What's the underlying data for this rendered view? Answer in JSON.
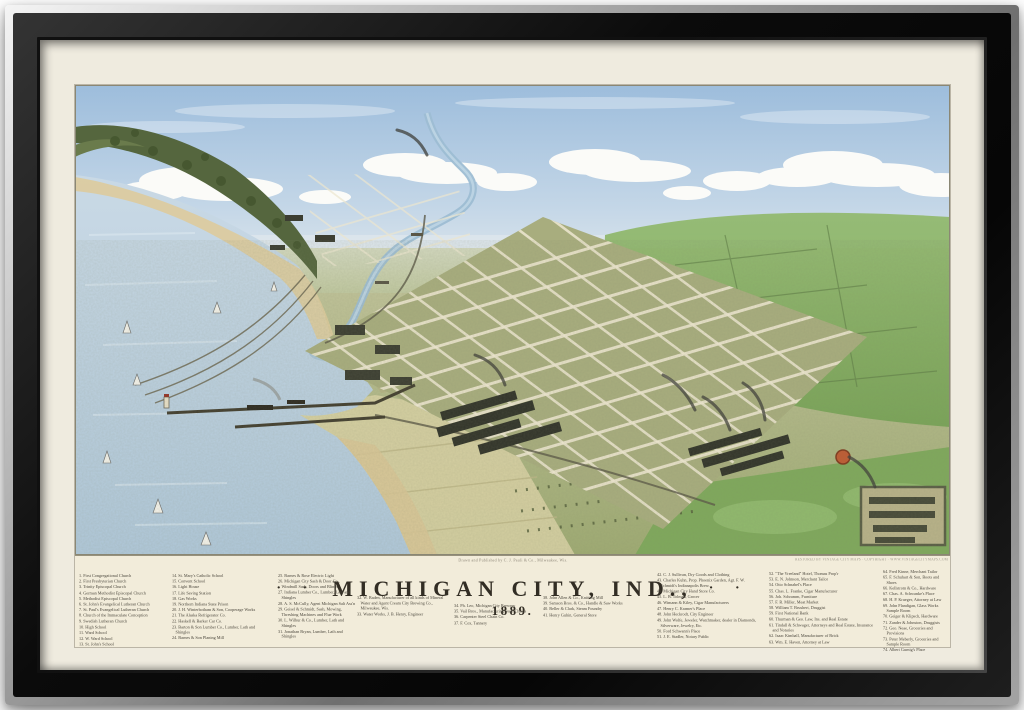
{
  "artwork": {
    "title": "MICHIGAN CITY, IND.,",
    "year": "1889.",
    "title_dots_left": "·  ·",
    "title_dots_right": "·  ·",
    "publisher_line": "Drawn and Published by C. J. Pauli & Co., Milwaukee, Wis.",
    "restored_line": "RESTORED BY VINTAGE CITY MAPS · COPYRIGHT · WWW.VINTAGECITYMAPS.COM"
  },
  "colors": {
    "frame_black": "#0b0b0b",
    "frame_silver": "#c2c2c2",
    "mat_cream": "#efebdf",
    "paper_cream": "#f2ecda",
    "sky_blue": "#a6c4e0",
    "lake_blue": "#b9cedd",
    "land_olive": "#a8ad7e",
    "field_green": "#82ae62",
    "ink": "#3a352b"
  },
  "legend": {
    "columns": [
      [
        "1. First Congregational Church",
        "2. First Presbyterian Church",
        "3. Trinity Episcopal Church",
        "4. German Methodist Episcopal Church",
        "5. Methodist Episcopal Church",
        "6. St. John's Evangelical Lutheran Church",
        "7. St. Paul's Evangelical Lutheran Church",
        "8. Church of the Immaculate Conception",
        "9. Swedish Lutheran Church",
        "10. High School",
        "11. Ward School",
        "12. W. Ward School",
        "13. St. John's School"
      ],
      [
        "14. St. Mary's Catholic School",
        "15. Convent School",
        "16. Light House",
        "17. Life Saving Station",
        "18. Gas Works",
        "19. Northern Indiana State Prison",
        "20. J. H. Winterbotham & Son, Cooperage Works",
        "21. The Alaska Refrigerator Co.",
        "22. Haskell & Barker Car Co.",
        "23. Barton & Son Lumber Co., Lumber, Lath and Shingles",
        "24. Barnes & Son Planing Mill"
      ],
      [
        "25. Barnes & Rose Electric Light",
        "26. Michigan City Sash & Door Co., Windmill Sash, Doors and Blinds",
        "27. Indiana Lumber Co., Lumber, Lath and Shingles",
        "28. A. S. McCully, Agent Michigan Salt Ass'n",
        "29. Geisel & Schmidt, Sash, Mowing, Threshing Machines and Flue Work",
        "30. L. Wilbur & Co., Lumber, Lath and Shingles",
        "31. Jonathan Bryan, Lumber, Lath and Shingles"
      ],
      [
        "32. W. Baden, Manufacturer of all kinds of Mineral Water and Agent Cream City Brewing Co., Milwaukee, Wis.",
        "33. Water Works, J. B. Henry, Engineer"
      ],
      [
        "34. Ph. Leo, Michigan City Brewery",
        "35. Vail Bros., Manufacturing Steel Chains",
        "36. Carpenter Steel Chain Co.",
        "37. F. Cox, Tannery"
      ],
      [
        "38. John Allen & Co., Knitting Mill",
        "39. Samson Bros. & Co., Handle & Saw Works",
        "40. Beller & Clark, Steam Foundry",
        "41. Henry Guhin, General Store"
      ],
      [
        "42. C. J. Sullivan, Dry Goods and Clothing",
        "43. Charles Kuhn, Prop. Phoenix Garden, Agt. F. W. Schmidt's Indianapolis Brew.",
        "44. Michigan City Hand Store Co.",
        "45. L. B. Tolman, Grocer",
        "46. Wimann & Kiley, Cigar Manufacturers",
        "47. Henry C. Kramer's Place",
        "48. John Heckrodt, City Engineer",
        "49. John Wolfe, Jeweler, Watchmaker, dealer in Diamonds, Silverware, Jewelry, Etc.",
        "50. Ford Schwann's Place",
        "51. J. E. Stadler, Notary Public"
      ],
      [
        "52. \"The Vreeland\" Hotel, Thomas Prop'r",
        "53. E. N. Johnson, Merchant Tailor",
        "54. Otto Schnabel's Place",
        "55. Chas. L. Franke, Cigar Manufacturer",
        "56. Joh. Schramm, Furniture",
        "57. F. R. Miller, Meat Market",
        "58. William T. Brushert, Druggist",
        "59. First National Bank",
        "60. Thurman & Geo. Law, Ins. and Real Estate",
        "61. Tindall & Schwager, Attorneys and Real Estate, Insurance and Notaries",
        "62. Isaac Kimball, Manufacturer of Brick",
        "63. Wm. E. Haven, Attorney at Law"
      ],
      [
        "64. Fred Kinne, Merchant Tailor",
        "65. F. Schuhart & Son, Boots and Shoes",
        "66. Kellstrom & Co., Hardware",
        "67. Chas. A. Schwanke's Place",
        "68. H. P. Krueger, Attorney at Law",
        "69. John Flandigan, Glass Works Sample Room",
        "70. Geiger & Klipsch, Hardware",
        "71. Zander & Johnston, Druggists",
        "72. Geo. Neae, Groceries and Provisions",
        "73. Peter Meberly, Groceries and Sample Room",
        "74. Albert Gurnig's Place"
      ]
    ]
  }
}
